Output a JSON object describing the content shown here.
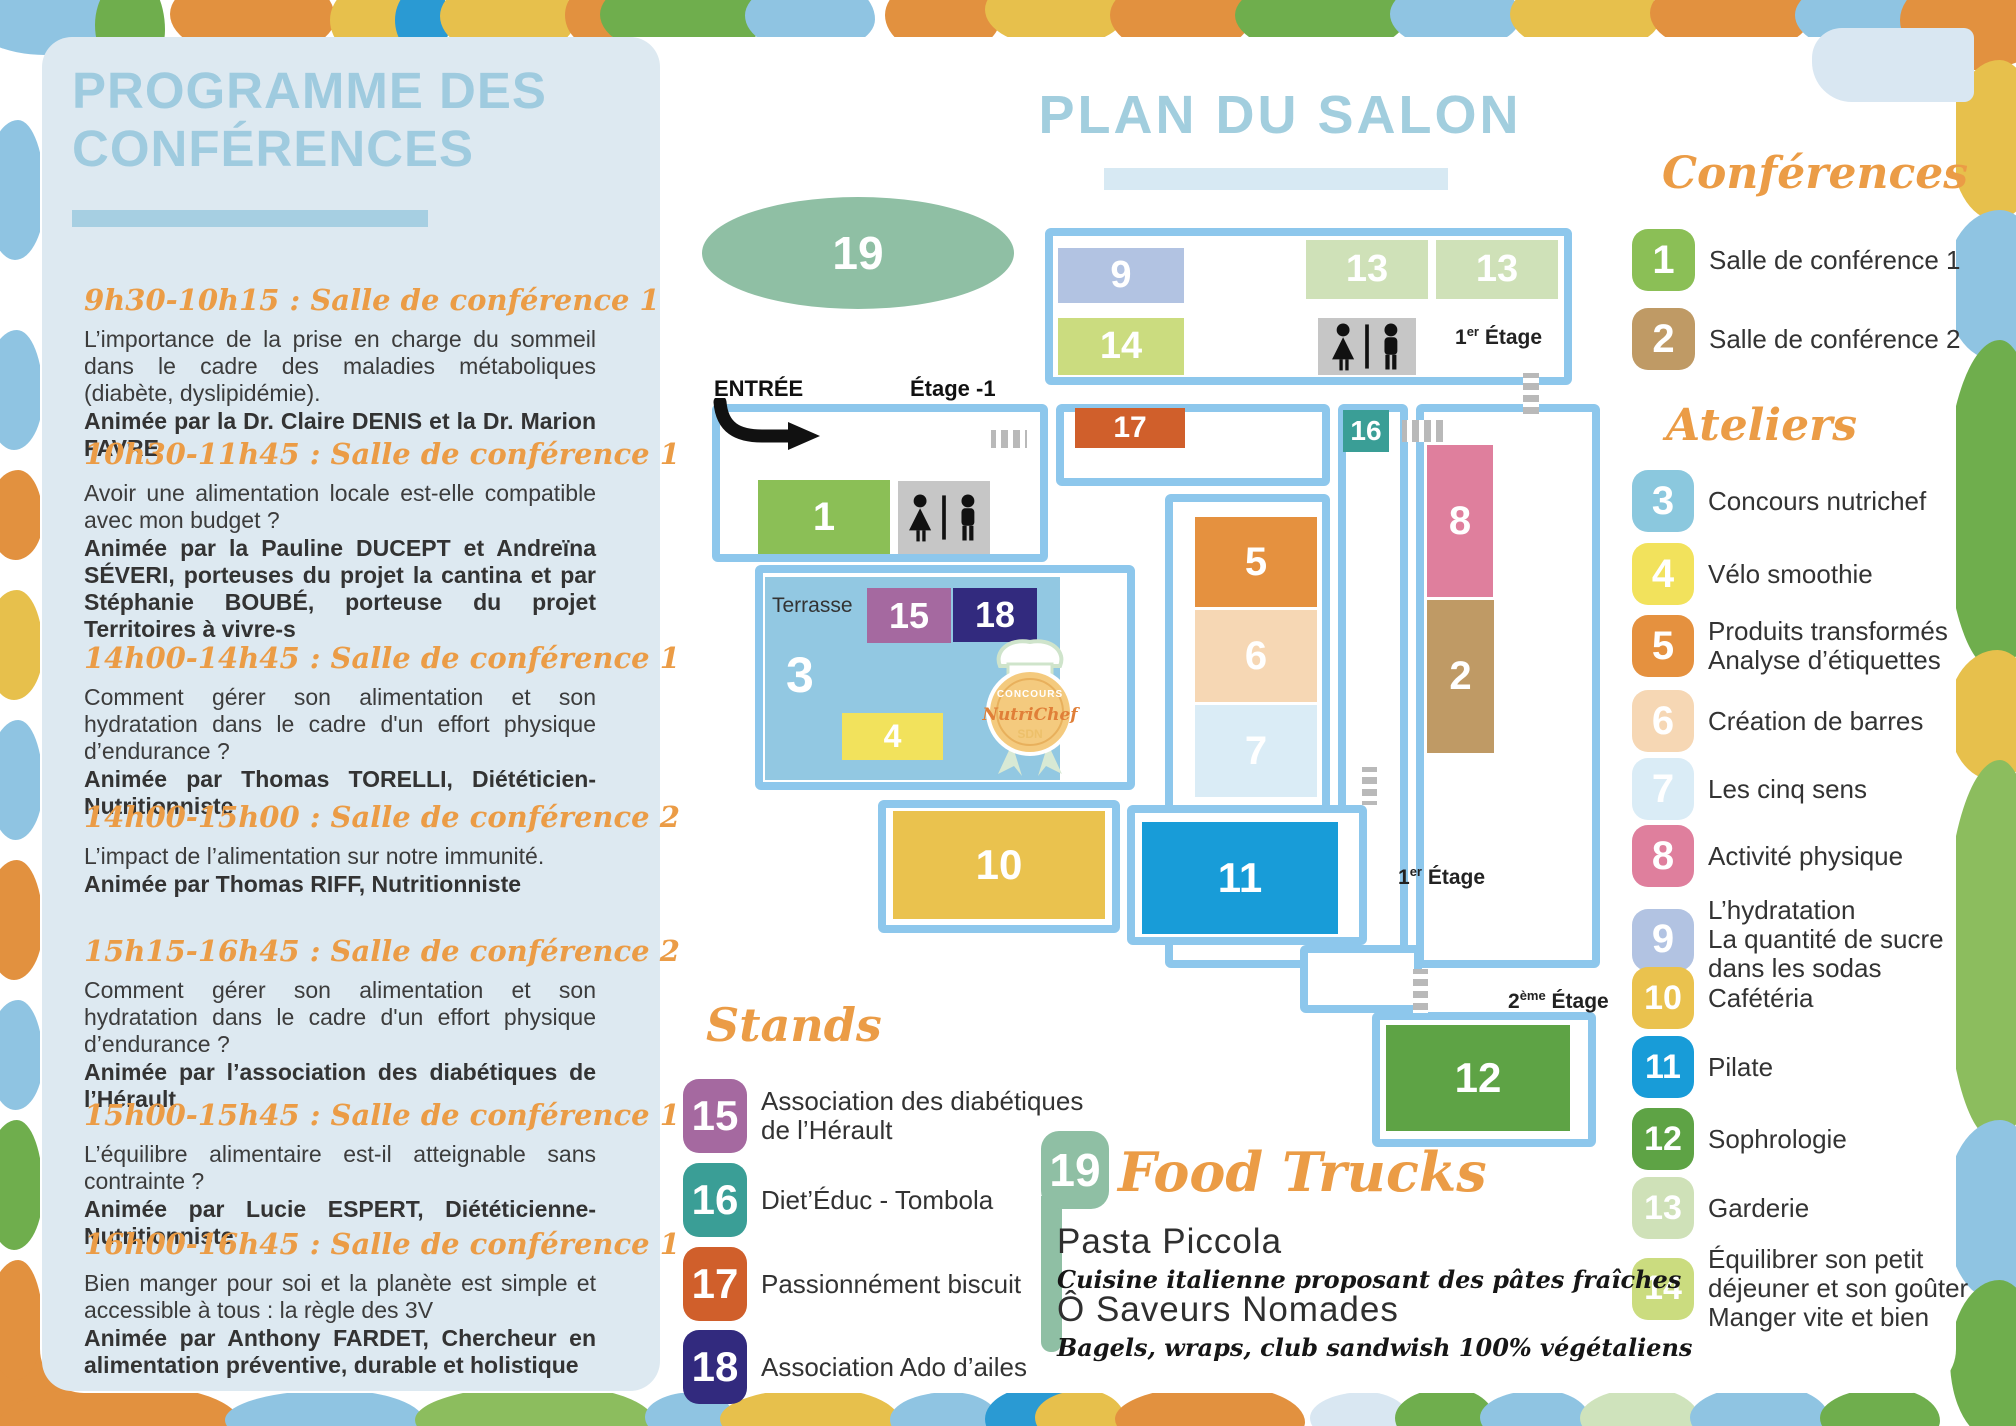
{
  "left_panel": {
    "title_line1": "PROGRAMME DES",
    "title_line2": "CONFÉRENCES",
    "sessions": [
      {
        "time": "9h30-10h15 : Salle de conférence 1",
        "desc": "L’importance de la prise en charge du sommeil dans le cadre des maladies métaboliques (diabète, dyslipidémie).",
        "host": "Animée par la Dr. Claire DENIS et la Dr. Marion FAVRE"
      },
      {
        "time": "10h30-11h45 : Salle de conférence 1",
        "desc": "Avoir une alimentation locale est-elle compatible avec mon budget ?",
        "host": "Animée par la Pauline DUCEPT et Andreïna SÉVERI, porteuses du projet la cantina et par Stéphanie BOUBÉ, porteuse du projet Territoires à vivre-s"
      },
      {
        "time": "14h00-14h45 : Salle de conférence 1",
        "desc": "Comment gérer son alimentation et son hydratation dans le cadre d'un effort physique d’endurance ?",
        "host": "Animée par Thomas TORELLI, Diététicien-Nutritionniste"
      },
      {
        "time": "14h00-15h00 : Salle de conférence 2",
        "desc": "L’impact de l’alimentation sur notre immunité.",
        "host": "Animée par Thomas RIFF, Nutritionniste"
      },
      {
        "time": "15h15-16h45 : Salle de conférence 2",
        "desc": "Comment gérer son alimentation et son hydratation dans le cadre d'un effort physique d’endurance ?",
        "host": "Animée par l’association des diabétiques de l’Hérault"
      },
      {
        "time": "15h00-15h45 : Salle de conférence 1",
        "desc": "L’équilibre alimentaire est-il atteignable sans contrainte ?",
        "host": "Animée par Lucie ESPERT, Diététicienne-Nutritionniste"
      },
      {
        "time": "16h00-16h45 : Salle de conférence 1",
        "desc": "Bien manger pour soi et la planète est simple et accessible à tous : la règle des 3V",
        "host": "Animée par Anthony FARDET, Chercheur en alimentation préventive, durable et holistique"
      }
    ]
  },
  "map": {
    "title": "PLAN DU SALON",
    "entree": "ENTRÉE",
    "etage_m1": "Étage -1",
    "terrasse": "Terrasse",
    "labels": {
      "et1": {
        "base": "1",
        "sup": "er",
        "rest": " Étage"
      },
      "et2": {
        "base": "2",
        "sup": "ème",
        "rest": " Étage"
      }
    },
    "rooms": {
      "r19": "19",
      "r9": "9",
      "r14": "14",
      "r13a": "13",
      "r13b": "13",
      "r1": "1",
      "r17": "17",
      "r16": "16",
      "r8": "8",
      "r2": "2",
      "r5": "5",
      "r6": "6",
      "r7": "7",
      "r15": "15",
      "r18": "18",
      "r3": "3",
      "r4": "4",
      "r10": "10",
      "r11": "11",
      "r12": "12"
    },
    "badge": {
      "top": "CONCOURS",
      "name": "NutriChef",
      "sub": "SDN"
    }
  },
  "legend": {
    "conferences_title": "Conférences",
    "conferences": [
      {
        "num": "1",
        "lines": [
          "Salle de conférence 1"
        ],
        "color": "#8bbf56"
      },
      {
        "num": "2",
        "lines": [
          "Salle de conférence 2"
        ],
        "color": "#bf9a65"
      }
    ],
    "ateliers_title": "Ateliers",
    "ateliers": [
      {
        "num": "3",
        "lines": [
          "Concours nutrichef"
        ],
        "color": "#8bc8de"
      },
      {
        "num": "4",
        "lines": [
          "Vélo smoothie"
        ],
        "color": "#f2e25c"
      },
      {
        "num": "5",
        "lines": [
          "Produits transformés",
          "Analyse d’étiquettes"
        ],
        "color": "#e5913f"
      },
      {
        "num": "6",
        "lines": [
          "Création de barres"
        ],
        "color": "#f6d7b4"
      },
      {
        "num": "7",
        "lines": [
          "Les cinq sens"
        ],
        "color": "#daecf6"
      },
      {
        "num": "8",
        "lines": [
          "Activité physique"
        ],
        "color": "#df7f9d"
      },
      {
        "num": "9",
        "lines": [
          "L’hydratation",
          "La quantité de sucre",
          "dans les sodas"
        ],
        "color": "#b2c3e2"
      },
      {
        "num": "10",
        "lines": [
          "Cafétéria"
        ],
        "color": "#eac24e"
      },
      {
        "num": "11",
        "lines": [
          "Pilate"
        ],
        "color": "#189cd8"
      },
      {
        "num": "12",
        "lines": [
          "Sophrologie"
        ],
        "color": "#5ea345"
      },
      {
        "num": "13",
        "lines": [
          "Garderie"
        ],
        "color": "#cfe1b8"
      },
      {
        "num": "14",
        "lines": [
          "Équilibrer son petit",
          "déjeuner et son goûter",
          "Manger vite et bien"
        ],
        "color": "#cbdc7f"
      }
    ]
  },
  "stands": {
    "title": "Stands",
    "items": [
      {
        "num": "15",
        "lines": [
          "Association des diabétiques",
          "de l’Hérault"
        ],
        "color": "#a569a0"
      },
      {
        "num": "16",
        "lines": [
          "Diet’Éduc - Tombola"
        ],
        "color": "#3a9e96"
      },
      {
        "num": "17",
        "lines": [
          "Passionnément biscuit"
        ],
        "color": "#d05f2b"
      },
      {
        "num": "18",
        "lines": [
          "Association Ado d’ailes"
        ],
        "color": "#322a7e"
      }
    ]
  },
  "food_trucks": {
    "num": "19",
    "color": "#8fbfa4",
    "title": "Food Trucks",
    "trucks": [
      {
        "name": "Pasta Piccola",
        "desc": "Cuisine italienne proposant des pâtes fraîches"
      },
      {
        "name": "Ô Saveurs Nomades",
        "desc": "Bagels, wraps, club sandwish 100% végétaliens"
      }
    ]
  }
}
